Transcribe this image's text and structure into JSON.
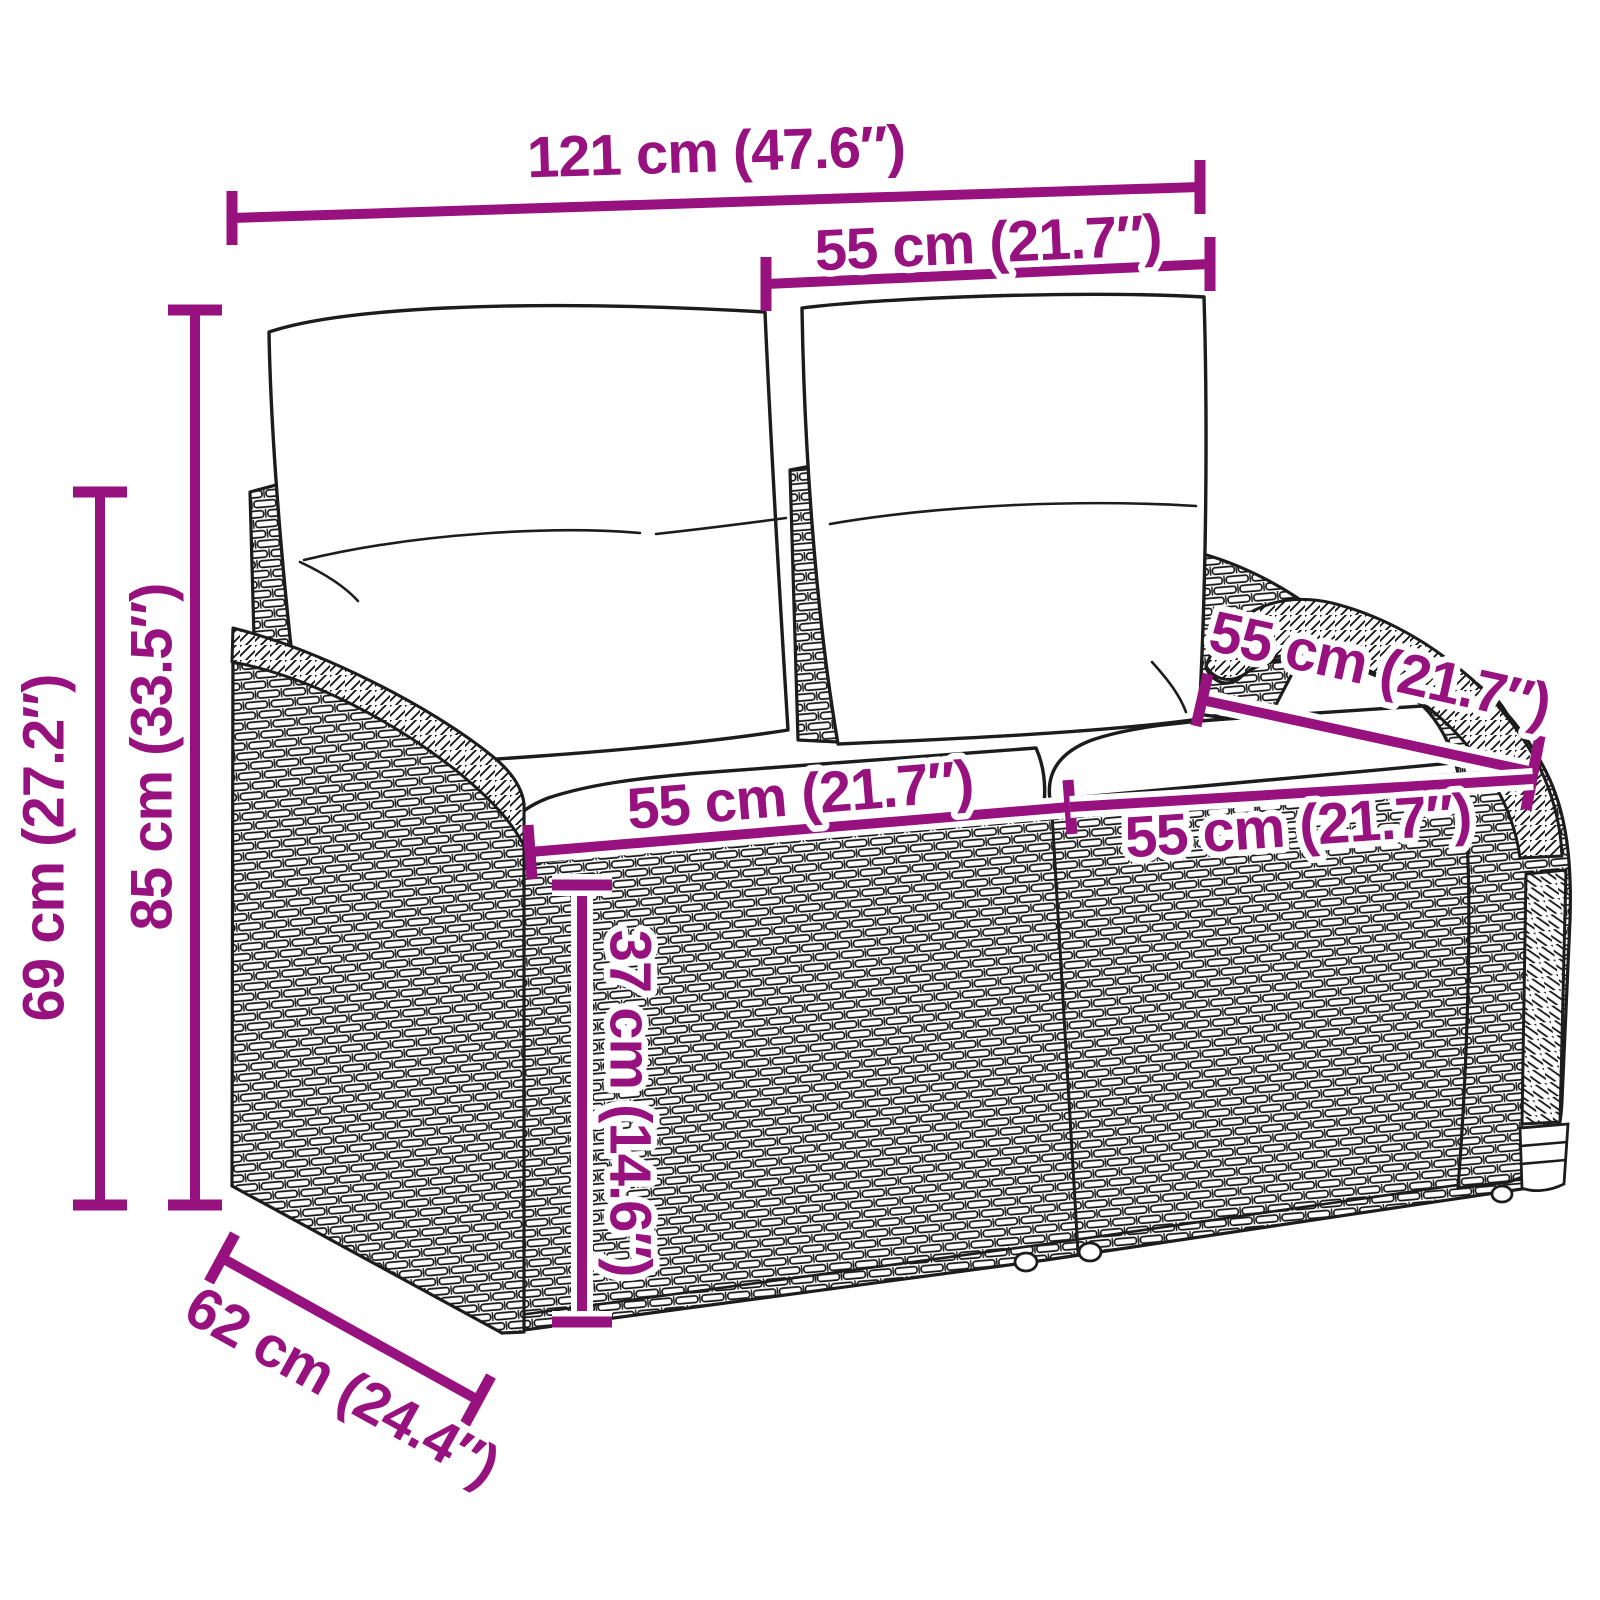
{
  "diagram": {
    "type": "product-dimension-diagram",
    "accent_color": "#97127E",
    "line_color": "#1c1c1c",
    "background_color": "#ffffff",
    "labels": {
      "overall_width": "121 cm (47.6″)",
      "backrest_width": "55 cm (21.7″)",
      "overall_height": "85 cm (33.5″)",
      "armrest_height": "69 cm (27.2″)",
      "seat_depth": "55 cm (21.7″)",
      "seat_width_left": "55 cm (21.7″)",
      "seat_width_right": "55 cm (21.7″)",
      "seat_height": "37 cm (14.6″)",
      "overall_depth": "62 cm (24.4″)"
    }
  }
}
